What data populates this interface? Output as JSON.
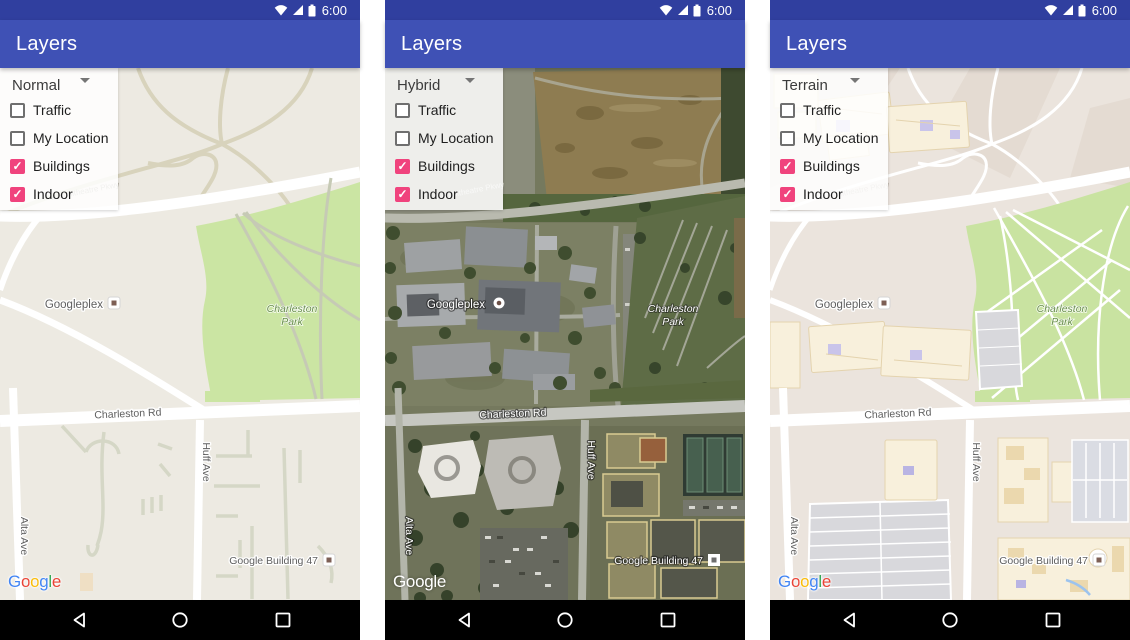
{
  "status_bar": {
    "time": "6:00"
  },
  "app_bar": {
    "title": "Layers"
  },
  "panels": [
    {
      "map_type": "Normal"
    },
    {
      "map_type": "Hybrid"
    },
    {
      "map_type": "Terrain"
    }
  ],
  "layer_options": [
    {
      "label": "Traffic",
      "checked": false
    },
    {
      "label": "My Location",
      "checked": false
    },
    {
      "label": "Buildings",
      "checked": true
    },
    {
      "label": "Indoor",
      "checked": true
    }
  ],
  "map_labels": {
    "googleplex": "Googleplex",
    "charleston_park_line1": "Charleston",
    "charleston_park_line2": "Park",
    "charleston_rd": "Charleston Rd",
    "amphitheatre_pkwy": "Amphitheatre Pkwy",
    "huff_ave": "Huff Ave",
    "alta_ave": "Alta Ave",
    "google_building_47": "Google Building 47"
  },
  "attribution": {
    "text": "Google",
    "letters": [
      {
        "ch": "G",
        "color": "#4285F4"
      },
      {
        "ch": "o",
        "color": "#EA4335"
      },
      {
        "ch": "o",
        "color": "#FBBC05"
      },
      {
        "ch": "g",
        "color": "#4285F4"
      },
      {
        "ch": "l",
        "color": "#34A853"
      },
      {
        "ch": "e",
        "color": "#EA4335"
      }
    ]
  },
  "navigation_bar": {
    "icons": [
      "back",
      "home",
      "recents"
    ]
  },
  "colors": {
    "status_bar": "#303F9F",
    "app_bar": "#3F51B5",
    "checkbox_checked": "#F0437D",
    "normal_map_bg": "#EDEAE2",
    "park_green": "#CBE5A3",
    "terrain_bg": "#EBE4DD"
  }
}
